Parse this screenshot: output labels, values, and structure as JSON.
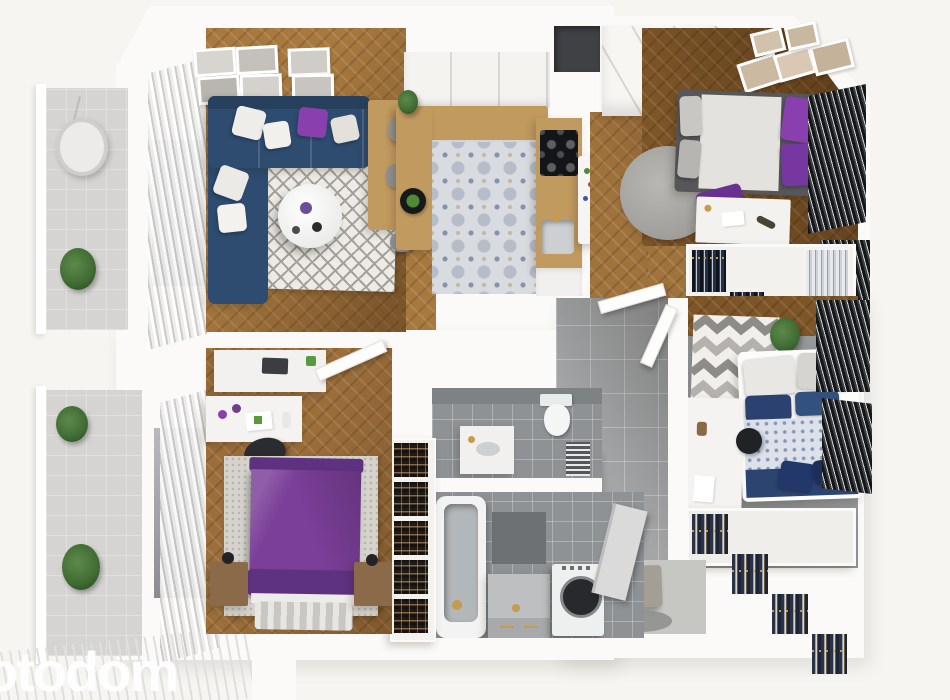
{
  "watermark": {
    "text": "otodom"
  },
  "palette": {
    "bg": "#f6f5f2",
    "wall": "#fbfaf8",
    "wood-living": "#a8793f",
    "wood-hall": "#a1733c",
    "wood-dark": "#7d5527",
    "wood-bed3": "#9c6e3a",
    "counter-wood": "#c19a5f",
    "sofa-navy": "#2e4c70",
    "sofa-dark": "#26405e",
    "accent-purple": "#8a3fae",
    "bed-purple": "#7b3f99",
    "navy-bedding": "#2b4270",
    "tile-kitchen": "#d8dbdf",
    "tile-gray": "#a3a5a6",
    "tile-dark": "#8e9295",
    "balcony-floor": "#d5d4d2",
    "rug-base": "#edebe6",
    "rug-line": "#a4a09a",
    "blind-dark": "#1c1e21",
    "gold": "#c79a4e",
    "plant-green": "#3f6b33",
    "watermark": "#ffffff"
  }
}
